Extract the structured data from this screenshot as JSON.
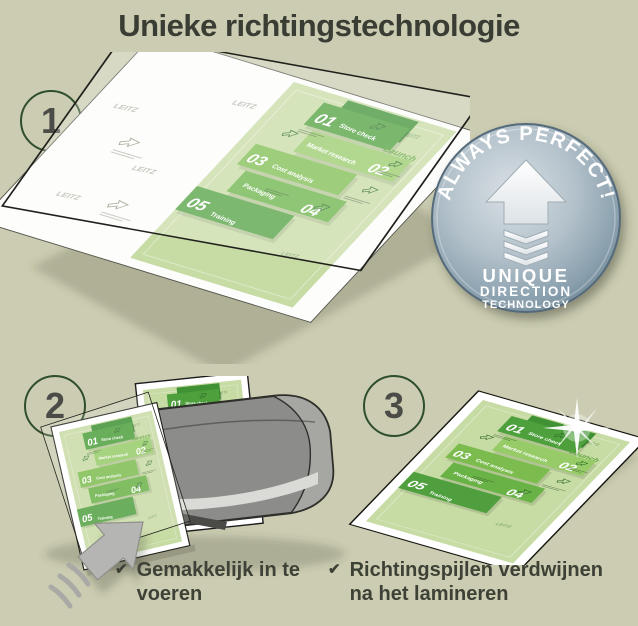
{
  "title": "Unieke richtingstechnologie",
  "steps": [
    {
      "number": "1"
    },
    {
      "number": "2"
    },
    {
      "number": "3"
    }
  ],
  "badge": {
    "arc_text": "ALWAYS PERFECT!",
    "line1": "UNIQUE",
    "line2": "DIRECTION",
    "line3": "TECHNOLOGY"
  },
  "document": {
    "items": [
      {
        "number": "01",
        "label": "Store check"
      },
      {
        "number": "02",
        "label": "Market research"
      },
      {
        "number": "03",
        "label": "Cost analysis"
      },
      {
        "number": "04",
        "label": "Packaging"
      },
      {
        "number": "05",
        "label": "Training"
      }
    ],
    "launch_label": "Launch",
    "watermark": "LEITZ"
  },
  "checklist": [
    {
      "text": "Gemakkelijk in te voeren"
    },
    {
      "text": "Richtingspijlen verdwijnen na het lamineren"
    }
  ],
  "icons": {
    "check": "✔"
  },
  "colors": {
    "background": "#cbccb1",
    "title": "#3a3d33",
    "circle_border": "#2f4e2c",
    "step_number": "#4b4b48",
    "checklist_text": "#3e4136",
    "doc_sheet": "#c7dba4",
    "block_greens": [
      "#4da03c",
      "#96cb67",
      "#7cbc4f",
      "#69b246",
      "#4f9f3e"
    ],
    "badge_face": "#9fb2bf",
    "badge_rim": "#546b7a",
    "laminator_gray": "#8c8c8a",
    "arrow_gray": "#b5b5b3"
  }
}
